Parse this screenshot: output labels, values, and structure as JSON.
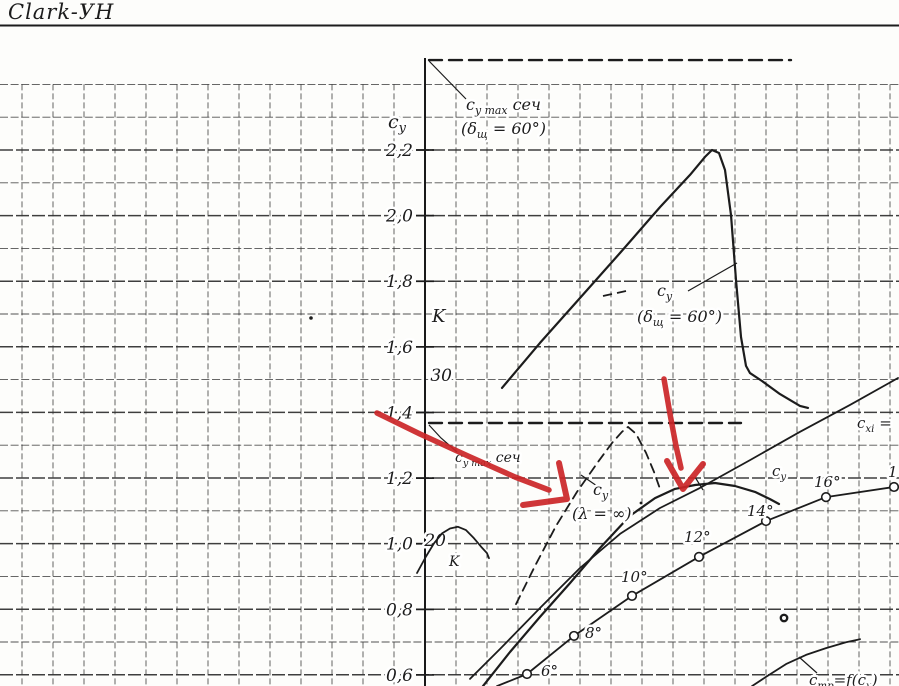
{
  "title": {
    "text": "Clark-УН"
  },
  "chart_data": {
    "type": "line",
    "title": "Clark-УН",
    "grid": true,
    "legend": "labels drawn inline on the plot",
    "y_axis": {
      "label": "cy",
      "ticks": [
        {
          "label": "2,2",
          "value": 2.2
        },
        {
          "label": "2,0",
          "value": 2.0
        },
        {
          "label": "1,8",
          "value": 1.8
        },
        {
          "label": "1,6",
          "value": 1.6
        },
        {
          "label": "1,4",
          "value": 1.4
        },
        {
          "label": "1,2",
          "value": 1.2
        },
        {
          "label": "1,0",
          "value": 1.0
        },
        {
          "label": "0,8",
          "value": 0.8
        },
        {
          "label": "0,6",
          "value": 0.6
        }
      ],
      "map": {
        "value_at_y150": 2.2,
        "px_per_unit": 328.1
      }
    },
    "secondary_y_axis": {
      "label": "K",
      "ticks": [
        {
          "label": "30",
          "value": 30,
          "x": 452
        },
        {
          "label": "20",
          "value": 20,
          "x": 446
        }
      ],
      "map": {
        "value_at_y375": 30,
        "px_per_unit": 16.5
      }
    },
    "x_axis": {
      "note": "abscissa scale is cropped out of the screenshot; x coordinates are image pixels"
    },
    "series": [
      {
        "id": "cymax_sech_flap_level",
        "label": "cy max сеч (δщ=60°) level",
        "units": "cy",
        "style": "dashed-bold",
        "points": [
          [
            429,
            2.474
          ],
          [
            791,
            2.474
          ]
        ]
      },
      {
        "id": "cymax_sech_level",
        "label": "cy max сеч level",
        "units": "cy",
        "style": "dashed-bold",
        "points": [
          [
            429,
            1.368
          ],
          [
            741,
            1.368
          ]
        ]
      },
      {
        "id": "cy_flap60",
        "label": "cy (δщ=60°)",
        "units": "cy",
        "style": "solid",
        "points": [
          [
            502,
            1.475
          ],
          [
            540,
            1.612
          ],
          [
            580,
            1.749
          ],
          [
            620,
            1.886
          ],
          [
            660,
            2.026
          ],
          [
            690,
            2.124
          ],
          [
            705,
            2.179
          ],
          [
            712,
            2.2
          ],
          [
            719,
            2.191
          ],
          [
            725,
            2.139
          ],
          [
            731,
            2.002
          ],
          [
            736,
            1.804
          ],
          [
            741,
            1.63
          ],
          [
            746,
            1.542
          ],
          [
            750,
            1.52
          ],
          [
            762,
            1.496
          ],
          [
            780,
            1.456
          ],
          [
            800,
            1.42
          ],
          [
            808,
            1.414
          ]
        ]
      },
      {
        "id": "cy_lambda_inf",
        "label": "cy (λ=∞)",
        "units": "cy",
        "style": "dashed",
        "points": [
          [
            516,
            0.816
          ],
          [
            535,
            0.932
          ],
          [
            556,
            1.054
          ],
          [
            577,
            1.158
          ],
          [
            598,
            1.249
          ],
          [
            612,
            1.307
          ],
          [
            622,
            1.341
          ],
          [
            628,
            1.356
          ],
          [
            636,
            1.335
          ],
          [
            646,
            1.277
          ],
          [
            654,
            1.219
          ],
          [
            660,
            1.167
          ]
        ]
      },
      {
        "id": "cy_wing",
        "label": "cy",
        "units": "cy",
        "style": "solid",
        "points": [
          [
            483,
            0.566
          ],
          [
            510,
            0.67
          ],
          [
            540,
            0.777
          ],
          [
            570,
            0.88
          ],
          [
            600,
            0.987
          ],
          [
            630,
            1.085
          ],
          [
            655,
            1.139
          ],
          [
            675,
            1.167
          ],
          [
            695,
            1.179
          ],
          [
            715,
            1.185
          ],
          [
            735,
            1.176
          ],
          [
            755,
            1.158
          ],
          [
            770,
            1.136
          ],
          [
            779,
            1.121
          ]
        ]
      },
      {
        "id": "cxi",
        "label": "cxi =",
        "units": "cy",
        "style": "solid-thin",
        "points": [
          [
            470,
            0.588
          ],
          [
            500,
            0.679
          ],
          [
            540,
            0.804
          ],
          [
            580,
            0.926
          ],
          [
            620,
            1.03
          ],
          [
            660,
            1.109
          ],
          [
            700,
            1.17
          ],
          [
            750,
            1.255
          ],
          [
            800,
            1.341
          ],
          [
            850,
            1.423
          ],
          [
            898,
            1.505
          ]
        ]
      },
      {
        "id": "cy_alpha",
        "label": "cy at angle of attack",
        "units": "cy",
        "style": "solid-thin",
        "points": [
          [
            497,
            0.566
          ],
          [
            527,
            0.603
          ],
          [
            574,
            0.719
          ],
          [
            632,
            0.841
          ],
          [
            699,
            0.96
          ],
          [
            766,
            1.069
          ],
          [
            826,
            1.142
          ],
          [
            894,
            1.173
          ]
        ],
        "markers": [
          {
            "x": 527,
            "value": 0.603,
            "label": "6°",
            "lx": 541,
            "ly": 676
          },
          {
            "x": 574,
            "value": 0.719,
            "label": "8°",
            "lx": 585,
            "ly": 638
          },
          {
            "x": 632,
            "value": 0.841,
            "label": "10°",
            "lx": 621,
            "ly": 582
          },
          {
            "x": 699,
            "value": 0.96,
            "label": "12°",
            "lx": 684,
            "ly": 542
          },
          {
            "x": 766,
            "value": 1.069,
            "label": "14°",
            "lx": 747,
            "ly": 516
          },
          {
            "x": 826,
            "value": 1.142,
            "label": "16°",
            "lx": 814,
            "ly": 487
          },
          {
            "x": 894,
            "value": 1.173,
            "label": "1",
            "lx": 888,
            "ly": 477
          }
        ]
      },
      {
        "id": "k_quality",
        "label": "K",
        "units": "k",
        "style": "solid-thin",
        "points": [
          [
            417,
            18.0
          ],
          [
            426,
            19.0
          ],
          [
            434,
            19.8
          ],
          [
            442,
            20.4
          ],
          [
            450,
            20.7
          ],
          [
            458,
            20.8
          ],
          [
            466,
            20.6
          ],
          [
            474,
            20.1
          ],
          [
            481,
            19.6
          ],
          [
            487,
            19.2
          ],
          [
            489,
            18.9
          ]
        ]
      },
      {
        "id": "ctp",
        "label": "cтр=f(cy)",
        "units": "cy",
        "style": "solid-thin",
        "points": [
          [
            752,
            0.566
          ],
          [
            766,
            0.594
          ],
          [
            786,
            0.633
          ],
          [
            806,
            0.661
          ],
          [
            826,
            0.682
          ],
          [
            846,
            0.7
          ],
          [
            860,
            0.709
          ]
        ]
      }
    ]
  },
  "text_labels": [
    {
      "id": "cy-axis-title",
      "x": 388,
      "y": 128,
      "size": 19,
      "segs": [
        {
          "t": "c"
        },
        {
          "t": "y",
          "sub": true
        }
      ]
    },
    {
      "id": "cymax-top-line1",
      "x": 466,
      "y": 110,
      "size": 16,
      "segs": [
        {
          "t": "c"
        },
        {
          "t": "y max",
          "sub": true
        },
        {
          "t": " сеч"
        }
      ]
    },
    {
      "id": "cymax-top-line2",
      "x": 461,
      "y": 134,
      "size": 16,
      "segs": [
        {
          "t": "("
        },
        {
          "t": "δ"
        },
        {
          "t": "щ",
          "sub": true
        },
        {
          "t": " = 60°)"
        }
      ]
    },
    {
      "id": "k-axis-title",
      "x": 432,
      "y": 322,
      "size": 18,
      "segs": [
        {
          "t": "K"
        }
      ]
    },
    {
      "id": "flap-curve-label-1",
      "x": 657,
      "y": 296,
      "size": 16,
      "segs": [
        {
          "t": "c"
        },
        {
          "t": "y",
          "sub": true
        }
      ]
    },
    {
      "id": "flap-curve-label-2",
      "x": 637,
      "y": 322,
      "size": 16,
      "segs": [
        {
          "t": "("
        },
        {
          "t": "δ"
        },
        {
          "t": "щ",
          "sub": true
        },
        {
          "t": " = 60°)"
        }
      ]
    },
    {
      "id": "cymax-mid-label",
      "x": 455,
      "y": 462,
      "size": 14,
      "segs": [
        {
          "t": "c"
        },
        {
          "t": "y max",
          "sub": true
        },
        {
          "t": " сеч"
        }
      ]
    },
    {
      "id": "lambda-label-1",
      "x": 593,
      "y": 495,
      "size": 16,
      "segs": [
        {
          "t": "c"
        },
        {
          "t": "y",
          "sub": true
        }
      ]
    },
    {
      "id": "lambda-label-2",
      "x": 572,
      "y": 519,
      "size": 16,
      "segs": [
        {
          "t": "(λ = ∞)"
        }
      ]
    },
    {
      "id": "cy-right-label",
      "x": 772,
      "y": 476,
      "size": 15,
      "segs": [
        {
          "t": "c"
        },
        {
          "t": "y",
          "sub": true
        }
      ]
    },
    {
      "id": "cxi-label",
      "x": 857,
      "y": 428,
      "size": 15,
      "segs": [
        {
          "t": "c"
        },
        {
          "t": "xi",
          "sub": true
        },
        {
          "t": " ="
        }
      ]
    },
    {
      "id": "ctp-label",
      "x": 809,
      "y": 685,
      "size": 15,
      "segs": [
        {
          "t": "c"
        },
        {
          "t": "тр",
          "sub": true
        },
        {
          "t": "=f(c"
        },
        {
          "t": "y",
          "sub": true
        },
        {
          "t": ")"
        }
      ]
    },
    {
      "id": "k-small-label",
      "x": 449,
      "y": 566,
      "size": 14,
      "segs": [
        {
          "t": "K"
        }
      ]
    }
  ],
  "annotations": {
    "red_color": "#cb2527",
    "ink_color": "#1c1c1c",
    "red_arrows": [
      {
        "shaft": [
          [
            377,
            413
          ],
          [
            420,
            434
          ],
          [
            468,
            456
          ],
          [
            515,
            477
          ],
          [
            549,
            490
          ]
        ],
        "head": [
          [
            559,
            463
          ],
          [
            567,
            499
          ],
          [
            523,
            505
          ]
        ]
      },
      {
        "shaft": [
          [
            664,
            379
          ],
          [
            670,
            414
          ],
          [
            676,
            446
          ],
          [
            681,
            468
          ]
        ],
        "head": [
          [
            667,
            461
          ],
          [
            683,
            489
          ],
          [
            703,
            464
          ]
        ]
      }
    ],
    "leaders": [
      [
        [
          429,
          61
        ],
        [
          466,
          99
        ]
      ],
      [
        [
          688,
          291
        ],
        [
          737,
          263
        ]
      ],
      [
        [
          429,
          425
        ],
        [
          441,
          438
        ],
        [
          457,
          452
        ]
      ],
      [
        [
          581,
          475
        ],
        [
          597,
          486
        ]
      ],
      [
        [
          799,
          657
        ],
        [
          817,
          673
        ]
      ],
      [
        [
          695,
          477
        ],
        [
          703,
          490
        ]
      ]
    ],
    "stray_dashes": [
      [
        [
          603,
          296
        ],
        [
          612,
          294
        ]
      ],
      [
        [
          617,
          293
        ],
        [
          626,
          291
        ]
      ]
    ],
    "specks": [
      {
        "x": 311,
        "y": 318,
        "r": 1.8,
        "ring": false
      },
      {
        "x": 784,
        "y": 618,
        "r": 3.2,
        "ring": true
      },
      {
        "x": 641,
        "y": 503,
        "r": 1.4,
        "ring": false
      }
    ]
  }
}
